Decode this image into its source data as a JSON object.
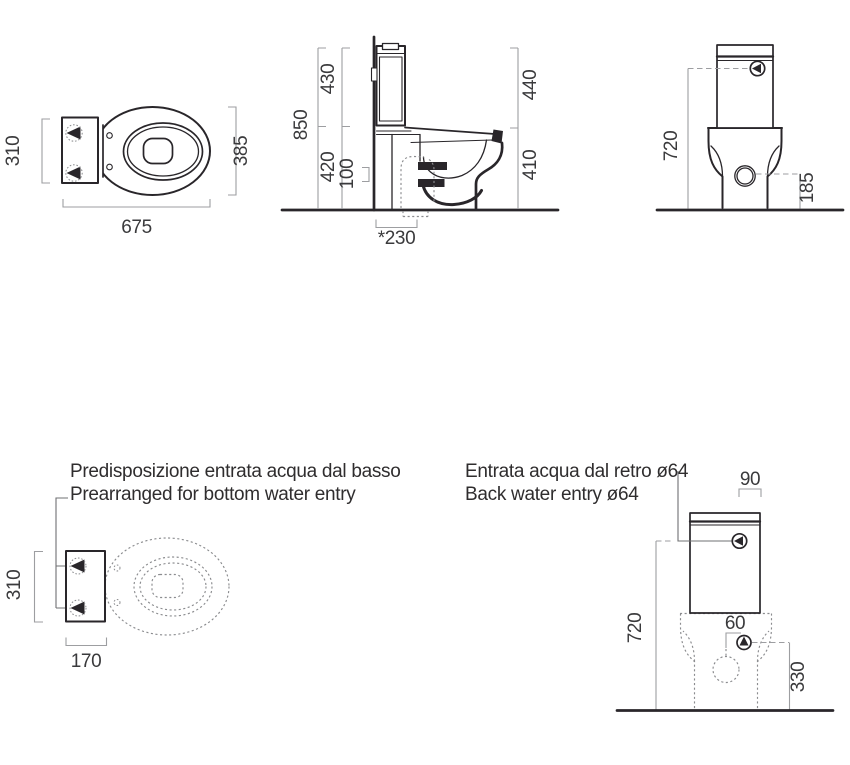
{
  "colors": {
    "line": "#29262a",
    "dimension_line": "#9d9ea1",
    "dashed_line": "#8b8c8f",
    "text": "#3a3a3c",
    "background": "#ffffff"
  },
  "icons": {
    "water_entry_marker": "filled-triangle-in-circle",
    "drain_hole": "double-circle"
  },
  "views": {
    "top_view": {
      "dim_tank_width": "310",
      "dim_bowl_width": "385",
      "dim_total_length": "675"
    },
    "side_view": {
      "dim_total_height": "850",
      "dim_cistern_height": "430",
      "dim_lower_height": "420",
      "dim_inlet_height": "100",
      "dim_back_height": "440",
      "dim_front_height": "410",
      "dim_outlet_from_wall": "*230"
    },
    "rear_view": {
      "dim_inlet_height": "720",
      "dim_side_hole_height": "185"
    },
    "bottom_entry_view": {
      "caption_line1": "Predisposizione entrata acqua dal basso",
      "caption_line2": "Prearranged for bottom water entry",
      "dim_tank_width": "310",
      "dim_tank_depth": "170"
    },
    "back_entry_view": {
      "caption_line1": "Entrata acqua dal retro ø64",
      "caption_line2": "Back water entry ø64",
      "dim_edge_offset": "90",
      "dim_inlet_height": "720",
      "dim_center_offset": "60",
      "dim_entry_height": "330"
    }
  }
}
